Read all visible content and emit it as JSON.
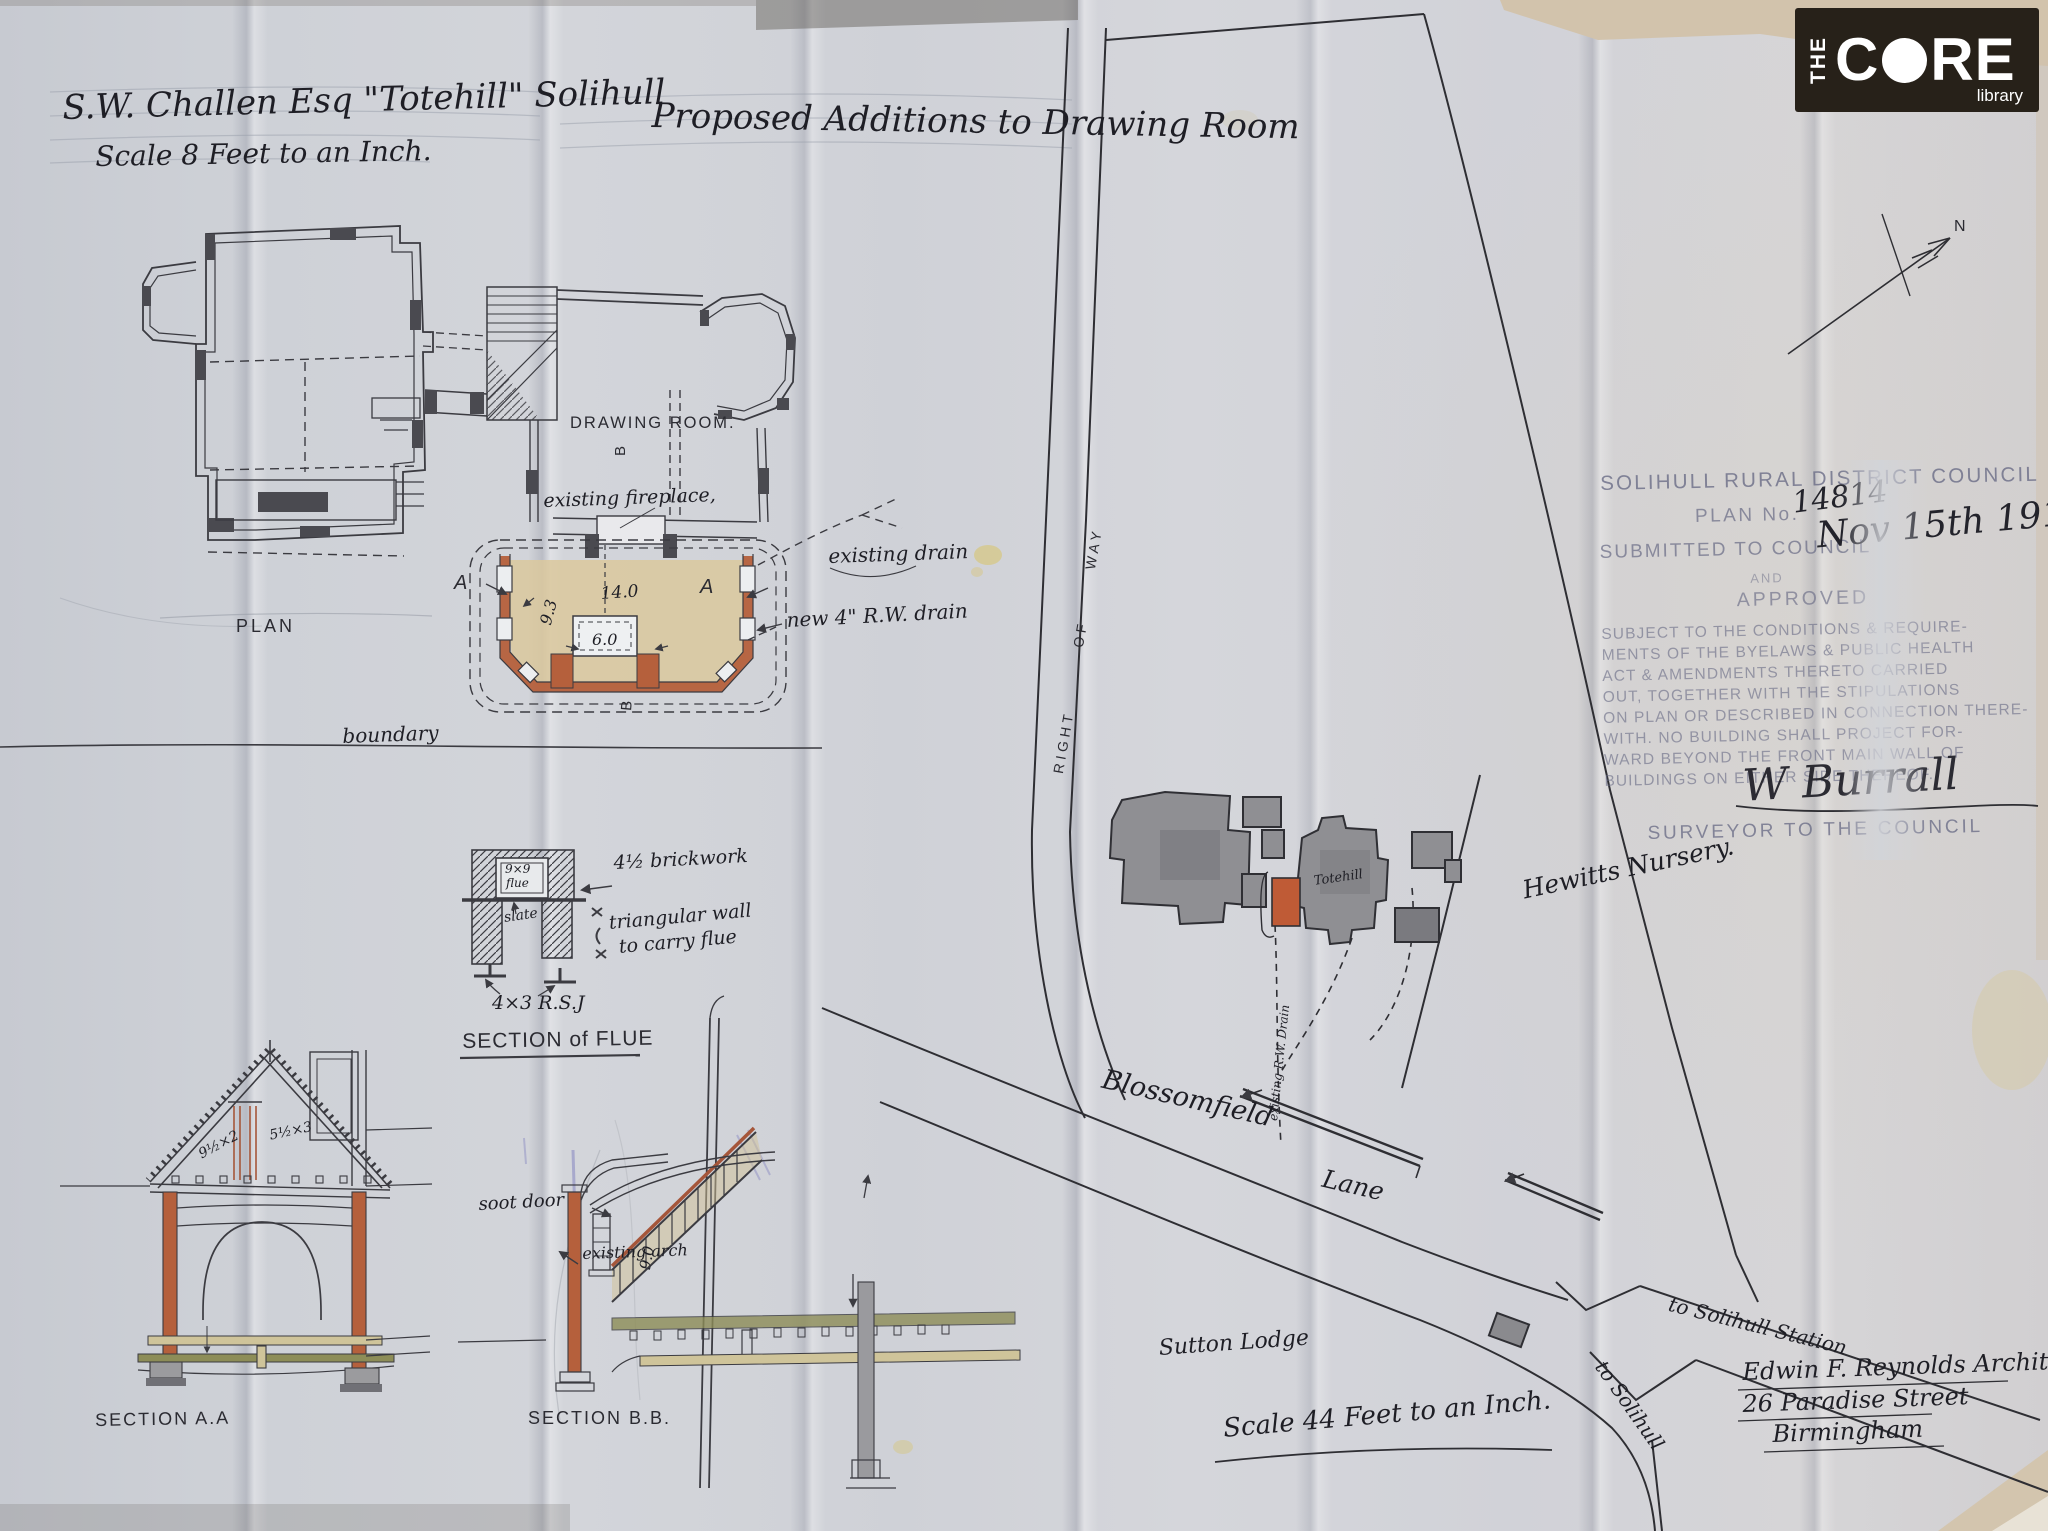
{
  "colors": {
    "paper": "#d1d3d8",
    "ink": "#3b3b41",
    "handwriting": "#1e1e25",
    "stamp": "#6b6d87",
    "new_wall_sienna": "#b5603c",
    "floor_tan": "#dac89c",
    "map_building_gray": "#8f8f93",
    "map_addition_red": "#bf5b36",
    "logo_background": "#272119",
    "logo_text": "#ffffff"
  },
  "header": {
    "client_title": "S.W. Challen Esq \"Totehill\" Solihull",
    "project_title": "Proposed Additions to Drawing Room",
    "scale_note": "Scale 8 Feet to an Inch."
  },
  "logo": {
    "the": "THE",
    "core_c": "C",
    "core_re": "RE",
    "library": "library"
  },
  "floor_plan": {
    "label": "PLAN",
    "room": "DRAWING ROOM.",
    "fireplace": "existing fireplace,",
    "existing_drain": "existing drain",
    "new_drain": "new 4\" R.W. drain",
    "boundary": "boundary",
    "marker_a": "A",
    "marker_b": "B",
    "dim_width": "14.0",
    "dim_depth": "9.3",
    "dim_hearth": "6.0"
  },
  "flue_section": {
    "title": "SECTION of FLUE",
    "flue_line1": "9×9",
    "flue_line2": "flue",
    "slate": "slate",
    "brickwork": "4½ brickwork",
    "triangular_wall_line1": "triangular wall",
    "triangular_wall_line2": "to carry flue",
    "rsj": "4×3 R.S.J"
  },
  "section_aa": {
    "title": "SECTION A.A",
    "rafter_dim": "9½×2",
    "beam_dim": "5½×3"
  },
  "section_bb": {
    "title": "SECTION B.B.",
    "soot_door": "soot door",
    "existing_arch": "existing arch",
    "height_dim": "9.0"
  },
  "site_map": {
    "right_of_way": [
      "RIGHT",
      "OF",
      "WAY"
    ],
    "house": "Totehill",
    "drain": "existing R.W. Drain",
    "nursery": "Hewitts Nursery.",
    "road1": "Blossomfield",
    "road2": "Lane",
    "lodge": "Sutton Lodge",
    "to_station": "to Solihull Station",
    "to_solihull": "to Solihull",
    "scale_note": "Scale 44 Feet to an Inch.",
    "compass_n": "N"
  },
  "stamp": {
    "council": "SOLIHULL RURAL DISTRICT COUNCIL",
    "plan_no_label": "PLAN No.",
    "plan_no": "14814",
    "submitted": "SUBMITTED TO COUNCIL",
    "date": "Nov 15th 1910",
    "and": "AND",
    "approved": "APPROVED",
    "body_line1": "SUBJECT TO THE CONDITIONS & REQUIRE-",
    "body_line2": "MENTS OF THE BYELAWS & PUBLIC HEALTH",
    "body_line3": "ACT & AMENDMENTS THERETO CARRIED",
    "body_line4": "OUT, TOGETHER WITH THE STIPULATIONS",
    "body_line5": "ON PLAN OR DESCRIBED IN CONNECTION THERE-",
    "body_line6": "WITH. NO BUILDING SHALL PROJECT FOR-",
    "body_line7": "WARD BEYOND THE FRONT MAIN WALL OF",
    "body_line8": "BUILDINGS ON EITHER SIDE THEREOF.",
    "signature": "W Burrall",
    "surveyor": "SURVEYOR TO THE COUNCIL"
  },
  "architect": {
    "line1": "Edwin F. Reynolds Architect",
    "line2": "26 Paradise Street",
    "line3": "Birmingham"
  }
}
